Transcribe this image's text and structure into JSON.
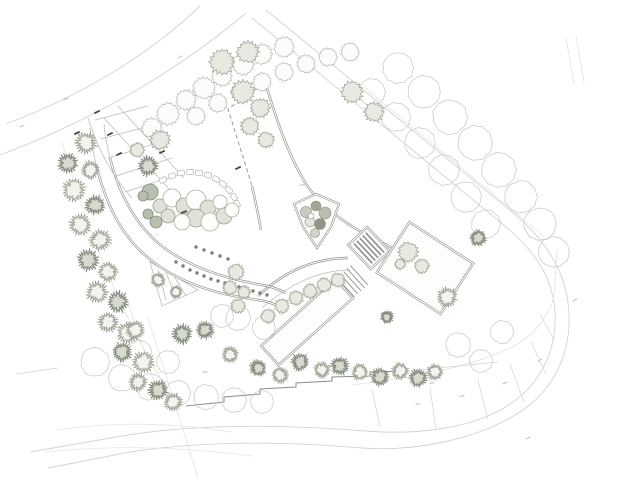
{
  "canvas": {
    "width": 640,
    "height": 480,
    "background": "#ffffff"
  },
  "palette": {
    "xfaint": "#e3e3e0",
    "faint": "#d3d3d0",
    "light": "#bdbdb9",
    "mid": "#8f8f8c",
    "dark": "#474745",
    "white": "#ffffff",
    "hedge_dot": "#7a8073",
    "stone_stroke": "#b4b4b0",
    "tick_faint": "#bdbdba"
  },
  "plan": {
    "paths": [
      {
        "name": "road-upper-outer",
        "c": "faint",
        "w": 0.9,
        "d": "M 6,124 C 80,96 148,56 200,6"
      },
      {
        "name": "road-upper-inner",
        "c": "faint",
        "w": 0.9,
        "d": "M 0,155 C 85,123 170,77 246,13"
      },
      {
        "name": "perimeter-road-inner",
        "c": "faint",
        "w": 0.9,
        "d": "M 252,18 L 500,222 C 540,254 553,282 555,312 C 557,354 538,388 504,408 C 468,429 416,435 366,431 C 290,425 205,423 128,435 L 30,452"
      },
      {
        "name": "perimeter-road-outer",
        "c": "faint",
        "w": 0.9,
        "d": "M 266,10 L 512,212 C 556,248 567,283 569,313 C 571,357 551,394 515,415 C 477,438 418,452 362,448 C 292,442 208,440 130,452 L 48,468"
      },
      {
        "name": "boundary-inner-diagonal",
        "c": "xfaint",
        "w": 0.8,
        "d": "M 358,82 L 548,240"
      },
      {
        "name": "parcel-chain",
        "c": "xfaint",
        "w": 0.8,
        "d": "M 352,385 C 420,377 470,366 506,350 C 532,338 547,320 554,297 L 557,250"
      },
      {
        "name": "parcel-dividers",
        "c": "faint",
        "w": 0.7,
        "d": "M 380,427 L 372,389 M 436,430 L 430,387 M 488,420 L 478,380 M 524,402 L 510,364 M 546,374 L 531,342 M 554,340 L 540,314"
      },
      {
        "name": "sw-boundary-1",
        "c": "xfaint",
        "w": 0.8,
        "d": "M 148,318 L 198,478"
      },
      {
        "name": "sw-boundary-2",
        "c": "xfaint",
        "w": 0.8,
        "d": "M 128,302 L 154,382"
      },
      {
        "name": "west-tick-line",
        "c": "faint",
        "w": 0.8,
        "d": "M 16,374 L 58,368"
      },
      {
        "name": "ne-drive-stub",
        "c": "xfaint",
        "w": 0.8,
        "d": "M 566,38 L 574,84 M 576,36 L 584,82"
      },
      {
        "name": "terrain-contour-1",
        "c": "xfaint",
        "w": 0.7,
        "d": "M 58,430 C 120,420 180,424 232,432"
      },
      {
        "name": "terrain-contour-2",
        "c": "xfaint",
        "w": 0.7,
        "d": "M 46,452 C 120,444 190,448 252,456"
      },
      {
        "name": "west-edge-under-trees",
        "c": "xfaint",
        "w": 0.8,
        "d": "M 62,142 C 82,212 112,300 172,398"
      },
      {
        "name": "plaza-right-edge",
        "c": "mid",
        "dbl": true,
        "d": "M 266,85 C 278,125 290,158 306,184 C 330,220 380,246 440,266"
      },
      {
        "name": "plaza-left-edge",
        "c": "mid",
        "dbl": true,
        "d": "M 252,186 C 256,204 259,218 261,230"
      },
      {
        "name": "plaza-top-dashed-edge",
        "c": "mid",
        "w": 0.9,
        "dash": "4 3",
        "d": "M 263,84 L 228,109 L 252,186"
      },
      {
        "name": "terrace-top-edge",
        "c": "mid",
        "dbl": true,
        "d": "M 258,296 C 288,268 318,258 348,258"
      },
      {
        "name": "terrace-lower-edge",
        "c": "light",
        "w": 0.8,
        "d": "M 262,308 C 292,282 322,270 350,270"
      },
      {
        "name": "drive-outer-edge",
        "c": "mid",
        "dbl": true,
        "d": "M 96,164 C 104,198 118,232 146,256 C 176,282 214,294 258,300 C 266,301 272,303 278,306"
      },
      {
        "name": "drive-inner-edge",
        "c": "mid",
        "dbl": true,
        "d": "M 110,158 C 118,190 132,220 158,243 C 186,266 222,278 262,285 C 270,286 278,289 286,293"
      },
      {
        "name": "drive-upper-stub",
        "c": "light",
        "w": 0.8,
        "d": "M 96,164 C 93,152 91,140 90,128 M 110,158 C 107,146 105,136 104,124"
      },
      {
        "name": "parking-grid",
        "c": "light",
        "w": 0.8,
        "d": "M 104,118 L 170,190 M 118,106 L 184,178 M 95,120 L 148,106 M 101,139 L 156,124 M 108,158 L 164,141 M 116,176 L 172,158 M 125,192 L 180,174"
      },
      {
        "name": "parking-arc",
        "c": "light",
        "w": 0.8,
        "d": "M 88,118 C 98,150 112,176 132,198"
      },
      {
        "name": "planting-triangle",
        "c": "light",
        "w": 0.8,
        "d": "M 150,262 L 198,290 L 162,306 Z M 158,270 L 166,300 M 166,272 L 176,298 M 174,276 L 186,296"
      },
      {
        "name": "retaining-wall-steps",
        "c": "mid",
        "w": 1.1,
        "d": "M 186,406 L 224,402 L 224,397 L 260,394 L 260,389 L 296,387 L 296,383 L 332,381 L 332,377 L 370,376 L 370,372 L 408,371"
      },
      {
        "name": "retaining-wall-extension",
        "c": "faint",
        "w": 0.8,
        "d": "M 408,371 L 498,362"
      }
    ],
    "wedge": {
      "outline": "294,204 316,194 339,204 331,227 317,248 303,227",
      "shrubs": [
        [
          306,
          212,
          5.5,
          "#c9cdc1"
        ],
        [
          316,
          206,
          5,
          "#a0a795"
        ],
        [
          325,
          213,
          6,
          "#b9beae"
        ],
        [
          310,
          222,
          5,
          "#e3e5de"
        ],
        [
          320,
          224,
          5.5,
          "#90978a"
        ],
        [
          315,
          233,
          4.5,
          "#d0d4c9"
        ],
        [
          311,
          216,
          3,
          "#ffffff"
        ]
      ]
    },
    "ramp": {
      "tx": 369,
      "ty": 248,
      "rot": -43,
      "w": 26,
      "h": 33,
      "stripes": [
        -8,
        -4,
        0,
        4,
        8
      ]
    },
    "plot": {
      "tx": 425,
      "ty": 268,
      "rot": 33,
      "w": 76,
      "h": 60
    },
    "pool": {
      "tx": 307,
      "ty": 322,
      "rot": -42,
      "w": 100,
      "h": 26,
      "steps": [
        52,
        56.5,
        61,
        65.5,
        70
      ]
    },
    "stones": [
      [
        163,
        180,
        -25
      ],
      [
        172,
        176,
        -18
      ],
      [
        181,
        173,
        -10
      ],
      [
        190,
        172,
        -3
      ],
      [
        199,
        173,
        5
      ],
      [
        208,
        175,
        14
      ],
      [
        216,
        179,
        24
      ],
      [
        223,
        184,
        34
      ],
      [
        229,
        190,
        44
      ],
      [
        234,
        197,
        54
      ],
      [
        237,
        204,
        62
      ]
    ],
    "shrubs": [
      [
        150,
        192,
        8,
        "d"
      ],
      [
        160,
        206,
        7,
        "m"
      ],
      [
        172,
        198,
        9,
        "o"
      ],
      [
        184,
        206,
        8,
        "m"
      ],
      [
        196,
        200,
        10,
        "o"
      ],
      [
        208,
        208,
        8,
        "m"
      ],
      [
        220,
        202,
        7,
        "o"
      ],
      [
        196,
        218,
        9,
        "m"
      ],
      [
        182,
        222,
        8,
        "o"
      ],
      [
        210,
        222,
        9,
        "o"
      ],
      [
        224,
        216,
        8,
        "m"
      ],
      [
        168,
        216,
        7,
        "m"
      ],
      [
        156,
        222,
        6,
        "d"
      ],
      [
        232,
        210,
        7,
        "o"
      ],
      [
        143,
        196,
        5,
        "d"
      ],
      [
        148,
        214,
        5,
        "d"
      ]
    ],
    "hedge_dots": [
      [
        176,
        262
      ],
      [
        183,
        266
      ],
      [
        190,
        270
      ],
      [
        197,
        273
      ],
      [
        204,
        276
      ],
      [
        211,
        279
      ],
      [
        218,
        281
      ],
      [
        225,
        283
      ],
      [
        232,
        285
      ],
      [
        239,
        287
      ],
      [
        246,
        289
      ],
      [
        253,
        291
      ],
      [
        260,
        293
      ],
      [
        267,
        295
      ],
      [
        196,
        247
      ],
      [
        204,
        250
      ],
      [
        212,
        253
      ],
      [
        220,
        256
      ],
      [
        228,
        259
      ]
    ],
    "tree_styles": {
      "canopy": {
        "n": 11,
        "inner": 0.96,
        "jit": 0.06,
        "stroke": "#cdcdc9",
        "fill": "none",
        "sw": 0.8
      },
      "fluffy": {
        "n": 15,
        "inner": 0.86,
        "jit": 0.1,
        "stroke": "#bcbfb6",
        "fill": "#fcfcfb",
        "sw": 0.8
      },
      "fluffyT": {
        "n": 16,
        "inner": 0.8,
        "jit": 0.14,
        "stroke": "#a2a79b",
        "fill": "#e8eae2",
        "sw": 0.8
      },
      "spiky": {
        "n": 22,
        "inner": 0.62,
        "jit": 0.2,
        "stroke": "#9aa091",
        "fill": "#f3f4f0",
        "sw": 0.8
      },
      "spikyDark": {
        "n": 22,
        "inner": 0.62,
        "jit": 0.22,
        "stroke": "#848a7d",
        "fill": "#d6dacf",
        "sw": 0.9
      }
    },
    "trees": {
      "canopy": [
        [
          398,
          68,
          16
        ],
        [
          424,
          92,
          17
        ],
        [
          450,
          117,
          18
        ],
        [
          475,
          143,
          18
        ],
        [
          499,
          170,
          18
        ],
        [
          521,
          197,
          17
        ],
        [
          540,
          224,
          17
        ],
        [
          554,
          252,
          16
        ],
        [
          372,
          92,
          14
        ],
        [
          396,
          117,
          15
        ],
        [
          420,
          143,
          16
        ],
        [
          444,
          170,
          16
        ],
        [
          466,
          197,
          16
        ],
        [
          486,
          224,
          15
        ],
        [
          95,
          362,
          15
        ],
        [
          122,
          378,
          14
        ],
        [
          150,
          387,
          14
        ],
        [
          178,
          393,
          13
        ],
        [
          206,
          397,
          13
        ],
        [
          234,
          400,
          13
        ],
        [
          262,
          402,
          12
        ],
        [
          168,
          362,
          12
        ],
        [
          140,
          352,
          12
        ],
        [
          238,
          318,
          13
        ],
        [
          264,
          328,
          12
        ],
        [
          222,
          316,
          12
        ],
        [
          458,
          345,
          13
        ],
        [
          481,
          361,
          12
        ],
        [
          502,
          332,
          12
        ]
      ],
      "fluffy": [
        [
          152,
          128,
          11
        ],
        [
          168,
          114,
          12
        ],
        [
          186,
          100,
          11
        ],
        [
          204,
          88,
          12
        ],
        [
          222,
          76,
          11
        ],
        [
          243,
          64,
          12
        ],
        [
          262,
          54,
          11
        ],
        [
          284,
          47,
          11
        ],
        [
          196,
          116,
          10
        ],
        [
          218,
          103,
          10
        ],
        [
          240,
          92,
          10
        ],
        [
          262,
          82,
          10
        ],
        [
          284,
          72,
          10
        ],
        [
          306,
          64,
          10
        ],
        [
          328,
          57,
          10
        ],
        [
          350,
          52,
          10
        ]
      ],
      "fluffyT": [
        [
          222,
          62,
          14
        ],
        [
          248,
          52,
          12
        ],
        [
          243,
          92,
          13
        ],
        [
          260,
          108,
          11
        ],
        [
          250,
          126,
          10
        ],
        [
          266,
          140,
          9
        ],
        [
          137,
          150,
          8
        ],
        [
          160,
          140,
          11
        ],
        [
          408,
          252,
          11
        ],
        [
          422,
          266,
          8
        ],
        [
          400,
          264,
          6
        ],
        [
          236,
          272,
          9
        ],
        [
          230,
          288,
          8
        ],
        [
          244,
          292,
          7
        ],
        [
          238,
          306,
          8
        ],
        [
          268,
          316,
          8
        ],
        [
          282,
          306,
          8
        ],
        [
          296,
          298,
          8
        ],
        [
          310,
          291,
          8
        ],
        [
          324,
          285,
          8
        ],
        [
          338,
          280,
          8
        ],
        [
          352,
          92,
          12
        ],
        [
          374,
          112,
          11
        ]
      ],
      "spiky": [
        [
          86,
          143,
          12
        ],
        [
          90,
          170,
          10
        ],
        [
          74,
          190,
          13
        ],
        [
          80,
          225,
          12
        ],
        [
          100,
          240,
          12
        ],
        [
          108,
          272,
          11
        ],
        [
          97,
          292,
          12
        ],
        [
          108,
          322,
          11
        ],
        [
          128,
          333,
          12
        ],
        [
          143,
          362,
          12
        ],
        [
          138,
          382,
          10
        ],
        [
          173,
          402,
          10
        ],
        [
          135,
          330,
          10
        ],
        [
          230,
          355,
          9
        ],
        [
          280,
          375,
          9
        ],
        [
          322,
          370,
          9
        ],
        [
          360,
          372,
          9
        ],
        [
          400,
          371,
          9
        ],
        [
          435,
          372,
          9
        ],
        [
          447,
          297,
          11
        ],
        [
          176,
          292,
          7
        ],
        [
          158,
          280,
          8
        ]
      ],
      "spikyDark": [
        [
          68,
          163,
          11
        ],
        [
          95,
          205,
          11
        ],
        [
          88,
          260,
          12
        ],
        [
          118,
          302,
          12
        ],
        [
          122,
          352,
          11
        ],
        [
          158,
          390,
          11
        ],
        [
          182,
          334,
          11
        ],
        [
          258,
          368,
          9
        ],
        [
          300,
          362,
          10
        ],
        [
          340,
          366,
          10
        ],
        [
          380,
          377,
          10
        ],
        [
          418,
          378,
          10
        ],
        [
          478,
          238,
          9
        ],
        [
          148,
          166,
          11
        ],
        [
          387,
          317,
          7
        ],
        [
          205,
          330,
          10
        ]
      ]
    },
    "micro_labels": {
      "dark": [
        [
          97,
          112,
          -25
        ],
        [
          77,
          133,
          -25
        ],
        [
          110,
          134,
          -25
        ],
        [
          119,
          154,
          -25
        ],
        [
          162,
          152,
          -25
        ],
        [
          238,
          168,
          -25
        ],
        [
          184,
          212,
          -20
        ]
      ],
      "faint": [
        [
          66,
          99,
          -20
        ],
        [
          22,
          126,
          -15
        ],
        [
          180,
          57,
          -30
        ],
        [
          302,
          185,
          -12
        ],
        [
          418,
          404,
          -8
        ],
        [
          462,
          396,
          -12
        ],
        [
          505,
          383,
          -20
        ],
        [
          540,
          360,
          -35
        ],
        [
          432,
          383,
          -5
        ],
        [
          205,
          372,
          -4
        ],
        [
          528,
          438,
          -30
        ],
        [
          575,
          300,
          -40
        ]
      ]
    }
  }
}
